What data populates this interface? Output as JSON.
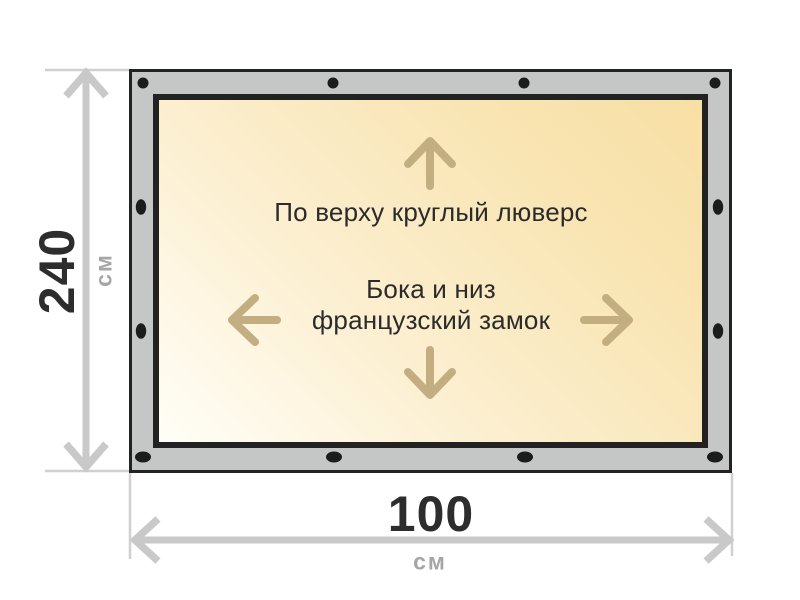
{
  "banner": {
    "top_note": "По верху круглый люверс",
    "center_note": "Бока и низ\nфранцузский замок"
  },
  "dimensions": {
    "height_value": "240",
    "height_unit": "см",
    "width_value": "100",
    "width_unit": "см"
  },
  "icons": {
    "up_arrow": "up-arrow-icon",
    "down_arrow": "down-arrow-icon",
    "left_arrow": "left-arrow-icon",
    "right_arrow": "right-arrow-icon",
    "grommet": "grommet-dot",
    "height_dimension": "vertical-dimension-arrow",
    "width_dimension": "horizontal-dimension-arrow"
  },
  "colors": {
    "frame_gray": "#c5c7c7",
    "frame_outline": "#222222",
    "banner_gradient_start": "#fffef7",
    "banner_gradient_end": "#f8dfa4",
    "direction_arrow": "#c2ae80",
    "dimension_line": "#c9c9c9",
    "dimension_value_text": "#2d2d2d",
    "dimension_unit_text": "#a6a6a6",
    "note_text": "#2b2b2b",
    "grommet": "#1c1c1c"
  }
}
